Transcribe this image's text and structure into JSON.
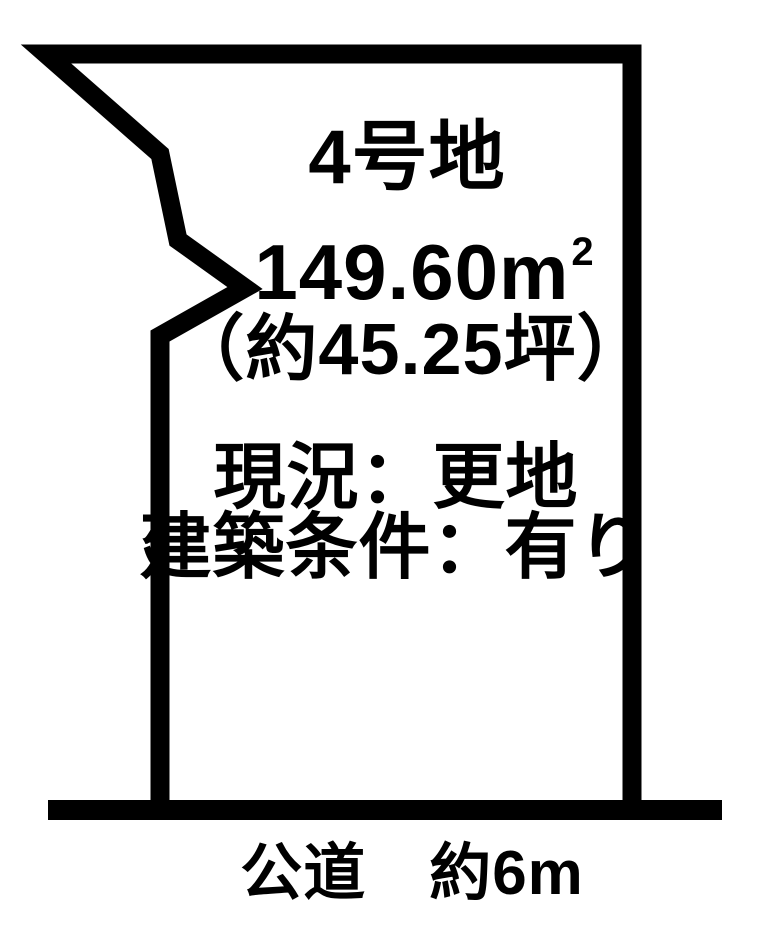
{
  "colors": {
    "ink": "#000000",
    "background": "#ffffff"
  },
  "plot": {
    "title": "4号地",
    "area_m2": "149.60m",
    "area_m2_sup": "2",
    "area_tsubo": "（約45.25坪）",
    "status_current": "現況：更地",
    "status_conditions": "建築条件：有り"
  },
  "road": {
    "label": "公道　約6m"
  }
}
